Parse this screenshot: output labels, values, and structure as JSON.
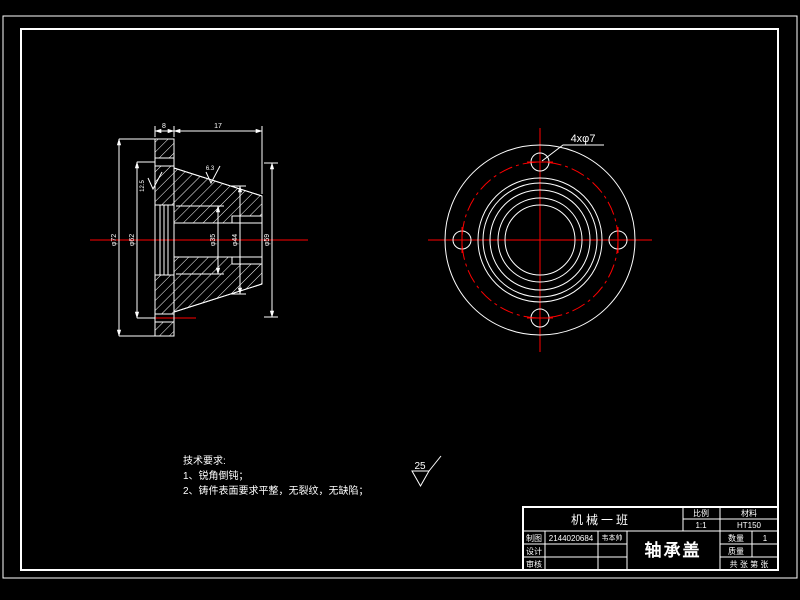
{
  "window": {
    "type": "cad-drawing-viewport",
    "background": "#000000"
  },
  "colors": {
    "line": "#ffffff",
    "centerline": "#ff0000",
    "background": "#000000"
  },
  "front_view": {
    "hole_note": "4xφ7"
  },
  "section_view": {
    "dims": {
      "top_flange_width": "8",
      "top_body_width": "17",
      "left_outer_dia": "φ72",
      "left_mid_dia": "φ62",
      "right_inner_dia": "φ35",
      "right_mid_dia": "φ44",
      "right_outer_dia": "φ59"
    },
    "roughness_face": "12.5",
    "roughness_taper": "6.3"
  },
  "general_roughness": {
    "value": "25"
  },
  "notes": {
    "heading": "技术要求:",
    "items": [
      "1、锐角倒钝；",
      "2、铸件表面要求平整，无裂纹，无缺陷；"
    ]
  },
  "title_block": {
    "class_name": "机械一班",
    "scale_label": "比例",
    "scale_value": "1:1",
    "material_label": "材料",
    "material_value": "HT150",
    "drawn_label": "制图",
    "drawn_id": "2144020684",
    "drawn_name": "韦本帅",
    "design_label": "设计",
    "review_label": "审核",
    "part_name": "轴承盖",
    "qty_label": "数量",
    "qty_value": "1",
    "mass_label": "质量",
    "sheets_label": "共  张  第  张"
  }
}
